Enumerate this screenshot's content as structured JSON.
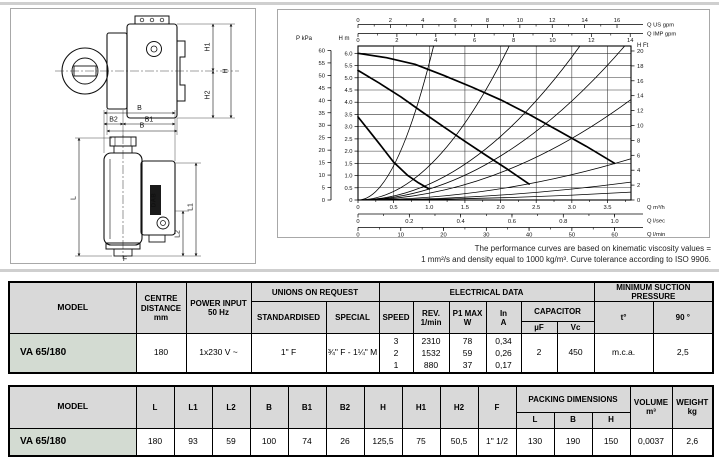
{
  "drawings": {
    "labels": {
      "H1": "H1",
      "H": "H",
      "H2": "H2",
      "B_top": "B",
      "B_side": "B",
      "B1": "B1",
      "B2": "B2",
      "L": "L",
      "L1": "L1",
      "L2": "L2",
      "F": "F",
      "logo": "DAB"
    }
  },
  "chart_data": {
    "type": "line",
    "title": "Circulator performance curves",
    "x_primary": {
      "label": "Q m³/h",
      "range": [
        0,
        3.83
      ],
      "ticks": [
        0,
        0.5,
        1,
        1.5,
        2,
        2.5,
        3,
        3.5
      ],
      "tick_labels": [
        "0",
        "0.5",
        "1.0",
        "1.5",
        "2.0",
        "2.5",
        "3.0",
        "3.5"
      ]
    },
    "x_secondary": [
      {
        "label": "Q US gpm",
        "factor": 0.2271,
        "ticks": [
          0,
          2,
          4,
          6,
          8,
          10,
          12,
          14,
          16
        ]
      },
      {
        "label": "Q IMP gpm",
        "factor": 0.2728,
        "ticks": [
          0,
          2,
          4,
          6,
          8,
          10,
          12,
          14
        ]
      },
      {
        "label": "Q l/sec",
        "factor": 3.6,
        "ticks": [
          0,
          0.2,
          0.4,
          0.6,
          0.8,
          1.0
        ],
        "tick_labels": [
          "0",
          "0.2",
          "0.4",
          "0.6",
          "0.8",
          "1.0"
        ]
      },
      {
        "label": "Q l/min",
        "factor": 0.06,
        "ticks": [
          0,
          10,
          20,
          30,
          40,
          50,
          60
        ]
      }
    ],
    "y_primary": {
      "label": "H m",
      "range": [
        0,
        6.3
      ],
      "ticks": [
        0,
        0.5,
        1,
        1.5,
        2,
        2.5,
        3,
        3.5,
        4,
        4.5,
        5,
        5.5,
        6
      ],
      "tick_labels": [
        "0",
        "0.5",
        "1.0",
        "1.5",
        "2.0",
        "2.5",
        "3.0",
        "3.5",
        "4.0",
        "4.5",
        "5.0",
        "5.5",
        "6.0"
      ]
    },
    "y_secondary": [
      {
        "label": "P kPa",
        "factor": 0.10197,
        "ticks": [
          0,
          5,
          10,
          15,
          20,
          25,
          30,
          35,
          40,
          45,
          50,
          55,
          60
        ]
      },
      {
        "label": "H Ft",
        "factor": 0.3048,
        "ticks": [
          0,
          2,
          4,
          6,
          8,
          10,
          12,
          14,
          16,
          18,
          20
        ]
      }
    ],
    "grid": {
      "x_step": 0.5,
      "y_step": 0.5
    },
    "series": [
      {
        "name": "speed 3",
        "points": [
          [
            0,
            6.0
          ],
          [
            0.4,
            5.82
          ],
          [
            0.8,
            5.55
          ],
          [
            1.2,
            5.1
          ],
          [
            1.6,
            4.62
          ],
          [
            2.0,
            4.1
          ],
          [
            2.4,
            3.5
          ],
          [
            2.8,
            2.85
          ],
          [
            3.2,
            2.2
          ],
          [
            3.6,
            1.5
          ]
        ]
      },
      {
        "name": "speed 2",
        "points": [
          [
            0,
            5.3
          ],
          [
            0.3,
            4.78
          ],
          [
            0.6,
            4.22
          ],
          [
            0.9,
            3.6
          ],
          [
            1.2,
            3.0
          ],
          [
            1.5,
            2.4
          ],
          [
            1.8,
            1.82
          ],
          [
            2.1,
            1.25
          ],
          [
            2.4,
            0.65
          ]
        ]
      },
      {
        "name": "speed 1",
        "points": [
          [
            0,
            3.4
          ],
          [
            0.15,
            2.85
          ],
          [
            0.3,
            2.3
          ],
          [
            0.5,
            1.55
          ],
          [
            0.7,
            1.0
          ],
          [
            0.85,
            0.7
          ],
          [
            1.0,
            0.45
          ]
        ]
      }
    ],
    "system_curves": {
      "form": "H = k·Q²",
      "k_values": [
        5.6,
        1.4,
        0.65,
        0.45,
        0.28,
        0.115,
        0.05,
        0.022
      ]
    },
    "note": [
      "The performance curves are based on kinematic viscosity values =",
      "1 mm²/s and density equal to 1000 kg/m³. Curve tolerance according to ISO 9906."
    ]
  },
  "table_specs": {
    "headers": {
      "model": "MODEL",
      "centre": "CENTRE DISTANCE",
      "centre_unit": "mm",
      "power": "POWER INPUT",
      "power_unit": "50 Hz",
      "unions": "UNIONS ON REQUEST",
      "standardised": "STANDARDISED",
      "special": "SPECIAL",
      "electrical": "ELECTRICAL DATA",
      "speed": "SPEED",
      "rev": "REV.",
      "rev_unit": "1/min",
      "p1": "P1 MAX",
      "p1_unit": "W",
      "in": "In",
      "in_unit": "A",
      "capacitor": "CAPACITOR",
      "uf": "µF",
      "vc": "Vc",
      "min_suction": "MINIMUM SUCTION PRESSURE",
      "t": "t°",
      "deg90": "90 °"
    },
    "row": {
      "model": "VA 65/180",
      "centre": "180",
      "power": "1x230 V ~",
      "standardised": "1\" F",
      "special": "¾\" F - 1¼\" M",
      "speeds": [
        "3",
        "2",
        "1"
      ],
      "rev": [
        "2310",
        "1532",
        "880"
      ],
      "p1": [
        "78",
        "59",
        "37"
      ],
      "in": [
        "0,34",
        "0,26",
        "0,17"
      ],
      "uf": "2",
      "vc": "450",
      "t": "m.c.a.",
      "deg90": "2,5"
    }
  },
  "table_dims": {
    "headers": {
      "model": "MODEL",
      "cols": [
        "L",
        "L1",
        "L2",
        "B",
        "B1",
        "B2",
        "H",
        "H1",
        "H2",
        "F"
      ],
      "packing": "PACKING DIMENSIONS",
      "pack_cols": [
        "L",
        "B",
        "H"
      ],
      "volume": "VOLUME",
      "volume_unit": "m³",
      "weight": "WEIGHT",
      "weight_unit": "kg"
    },
    "row": {
      "model": "VA 65/180",
      "values": [
        "180",
        "93",
        "59",
        "100",
        "74",
        "26",
        "125,5",
        "75",
        "50,5",
        "1\" 1/2"
      ],
      "packing": [
        "130",
        "190",
        "150"
      ],
      "volume": "0,0037",
      "weight": "2,6"
    }
  }
}
